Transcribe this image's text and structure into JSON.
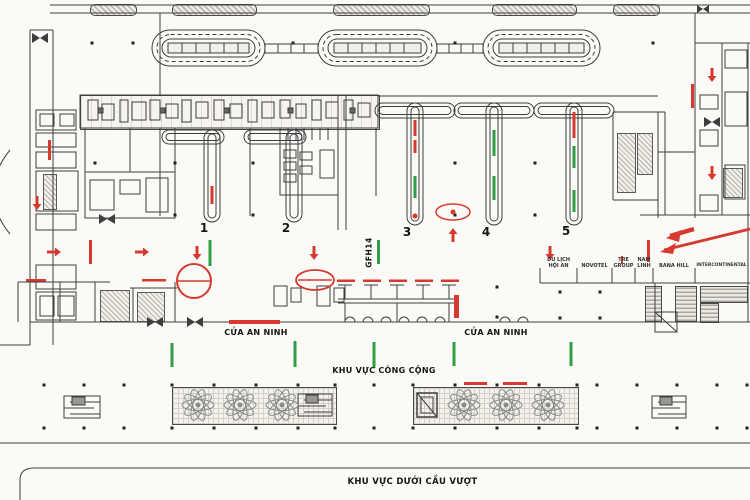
{
  "plan": {
    "gate_code": "GFH14",
    "security_label_1": "CỬA AN NINH",
    "security_label_2": "CỬA AN NINH",
    "public_area_label": "KHU VỰC CÔNG CỘNG",
    "underpass_label": "KHU VỰC DƯỚI CẦU VƯỢT",
    "islands": [
      {
        "number": "1"
      },
      {
        "number": "2"
      },
      {
        "number": "3"
      },
      {
        "number": "4"
      },
      {
        "number": "5"
      }
    ],
    "concessions": [
      {
        "label": "DU LỊCH\nHỘI AN"
      },
      {
        "label": "NOVOTEL"
      },
      {
        "label": "TRE\nGROUP"
      },
      {
        "label": "NAM\nLINH"
      },
      {
        "label": "BANA HILL"
      },
      {
        "label": "INTERCONTINENTAL"
      }
    ]
  },
  "colors": {
    "annotation_red": "#d63a2f",
    "wayfinding_green": "#2f9e44",
    "background": "#fbfaf7"
  }
}
